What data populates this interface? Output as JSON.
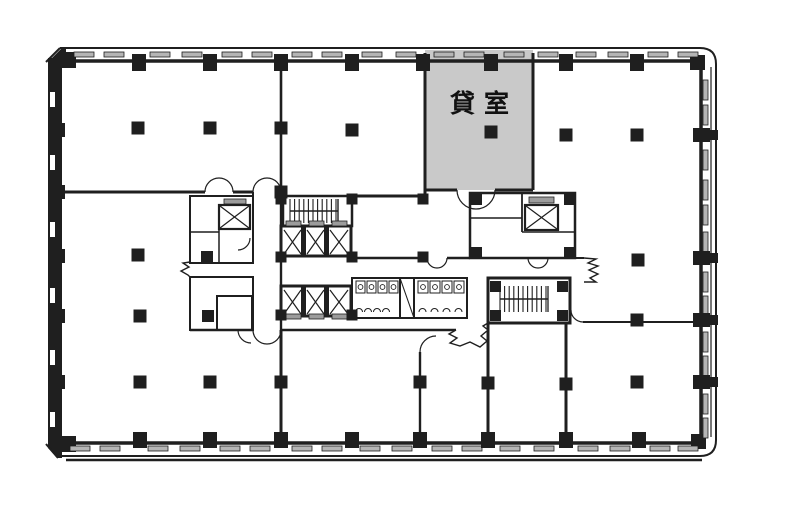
{
  "page": {
    "background": "#ffffff"
  },
  "floorplan": {
    "type": "office-building-floor-plan",
    "highlighted_room": {
      "label": "貸室",
      "fill": "#c9c9c9"
    },
    "line_color": "#1f1f1f",
    "window_pane_fill": "#b5b5b5",
    "elevator_door_fill": "#9c9c9c"
  }
}
